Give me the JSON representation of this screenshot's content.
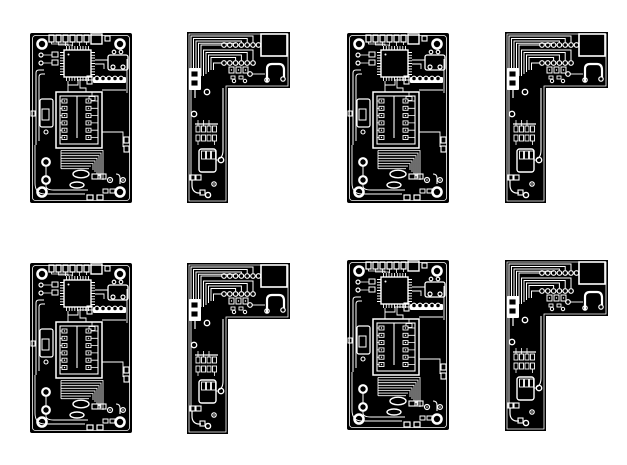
{
  "page": {
    "width": 627,
    "height": 465,
    "background": "#ffffff"
  },
  "artwork": {
    "board_color": "#000000",
    "trace_color": "#ffffff",
    "board_types": {
      "rect": {
        "symbol": "sym-rect-board",
        "name": "rectangular-pcb-board",
        "width": 102,
        "height": 170
      },
      "lshape": {
        "symbol": "sym-l-board",
        "name": "l-shaped-pcb-board",
        "width": 103,
        "height": 171
      }
    },
    "boards": [
      {
        "type": "rect",
        "x": 30,
        "y": 33
      },
      {
        "type": "lshape",
        "x": 187,
        "y": 32
      },
      {
        "type": "rect",
        "x": 347,
        "y": 33
      },
      {
        "type": "lshape",
        "x": 505,
        "y": 32
      },
      {
        "type": "rect",
        "x": 30,
        "y": 263
      },
      {
        "type": "lshape",
        "x": 187,
        "y": 263
      },
      {
        "type": "rect",
        "x": 347,
        "y": 260
      },
      {
        "type": "lshape",
        "x": 505,
        "y": 260
      }
    ]
  }
}
